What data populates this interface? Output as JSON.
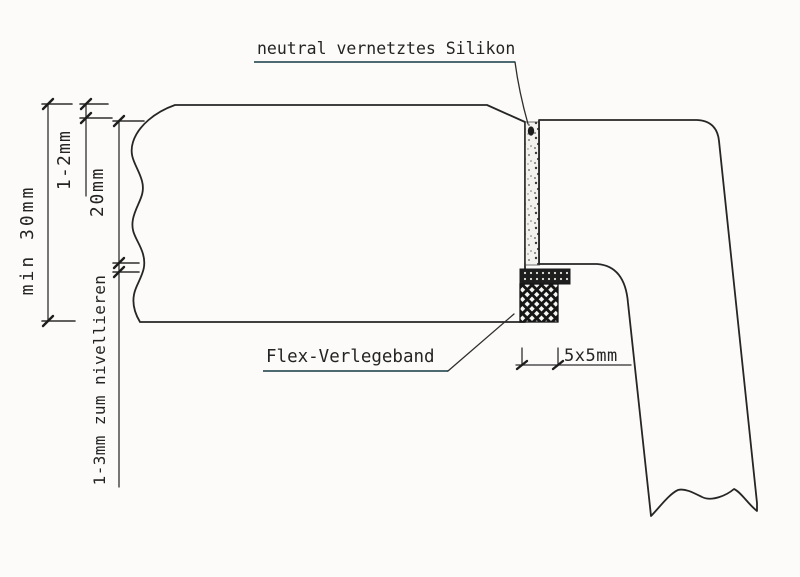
{
  "diagram": {
    "background_color": "#fcfbf9",
    "ink_color": "#262626",
    "labels": {
      "silicone": "neutral vernetztes Silikon",
      "flex_tape": "Flex-Verlegeband"
    },
    "dimensions": {
      "worktop_thickness": "min 30mm",
      "top_reveal": "1-2mm",
      "joint_depth": "20mm",
      "leveling_gap": "1-3mm zum nivellieren",
      "tape_size": "5x5mm"
    }
  }
}
